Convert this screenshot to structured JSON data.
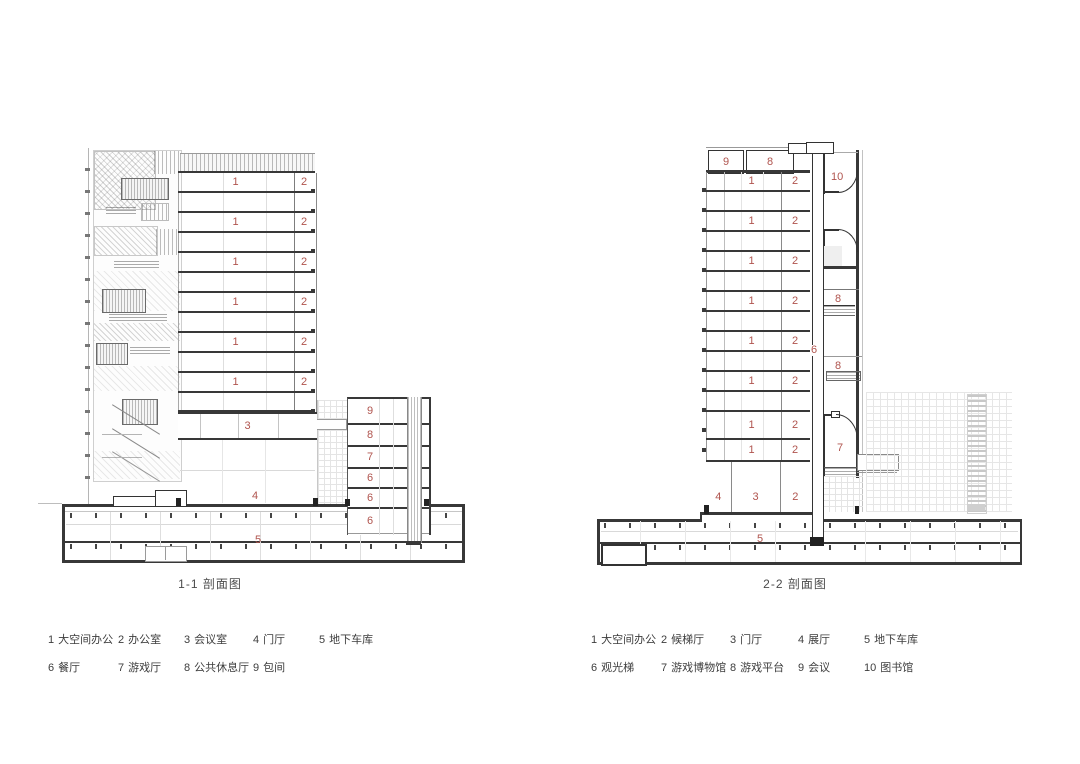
{
  "colors": {
    "label_red": "#b0544e",
    "slab_dark": "#383838",
    "light_line": "#d9d9d9"
  },
  "left_drawing": {
    "title": "1-1 剖面图",
    "tower_floors": [
      {
        "z1": "1",
        "z2": "2"
      },
      {
        "z1": "1",
        "z2": "2"
      },
      {
        "z1": "1",
        "z2": "2"
      },
      {
        "z1": "1",
        "z2": "2"
      },
      {
        "z1": "1",
        "z2": "2"
      },
      {
        "z1": "1",
        "z2": "2"
      }
    ],
    "meeting_room": "3",
    "lobby": "4",
    "garage": "5",
    "annex_floors": [
      "9",
      "8",
      "7",
      "6",
      "6",
      "6"
    ]
  },
  "right_drawing": {
    "title": "2-2 剖面图",
    "roof_rooms": [
      "9",
      "8"
    ],
    "library": "10",
    "tower_floors": [
      {
        "z1": "1",
        "z2": "2"
      },
      {
        "z1": "1",
        "z2": "2"
      },
      {
        "z1": "1",
        "z2": "2"
      },
      {
        "z1": "1",
        "z2": "2"
      },
      {
        "z1": "1",
        "z2": "2"
      },
      {
        "z1": "1",
        "z2": "2"
      },
      {
        "z1": "1",
        "z2": "2"
      },
      {
        "z1": "1",
        "z2": "2"
      }
    ],
    "elevator": "6",
    "platforms": [
      "8",
      "8"
    ],
    "museum": "7",
    "ground_rooms": [
      "4",
      "3",
      "2"
    ],
    "garage": "5"
  },
  "legend_left": {
    "rows": [
      [
        {
          "n": "1",
          "t": "大空间办公"
        },
        {
          "n": "2",
          "t": "办公室"
        },
        {
          "n": "3",
          "t": "会议室"
        },
        {
          "n": "4",
          "t": "门厅"
        },
        {
          "n": "5",
          "t": "地下车库"
        }
      ],
      [
        {
          "n": "6",
          "t": "餐厅"
        },
        {
          "n": "7",
          "t": "游戏厅"
        },
        {
          "n": "8",
          "t": "公共休息厅"
        },
        {
          "n": "9",
          "t": "包间"
        }
      ]
    ]
  },
  "legend_right": {
    "rows": [
      [
        {
          "n": "1",
          "t": "大空间办公"
        },
        {
          "n": "2",
          "t": "候梯厅"
        },
        {
          "n": "3",
          "t": "门厅"
        },
        {
          "n": "4",
          "t": "展厅"
        },
        {
          "n": "5",
          "t": "地下车库"
        }
      ],
      [
        {
          "n": "6",
          "t": "观光梯"
        },
        {
          "n": "7",
          "t": "游戏博物馆"
        },
        {
          "n": "8",
          "t": "游戏平台"
        },
        {
          "n": "9",
          "t": "会议"
        },
        {
          "n": "10",
          "t": "图书馆"
        }
      ]
    ]
  }
}
